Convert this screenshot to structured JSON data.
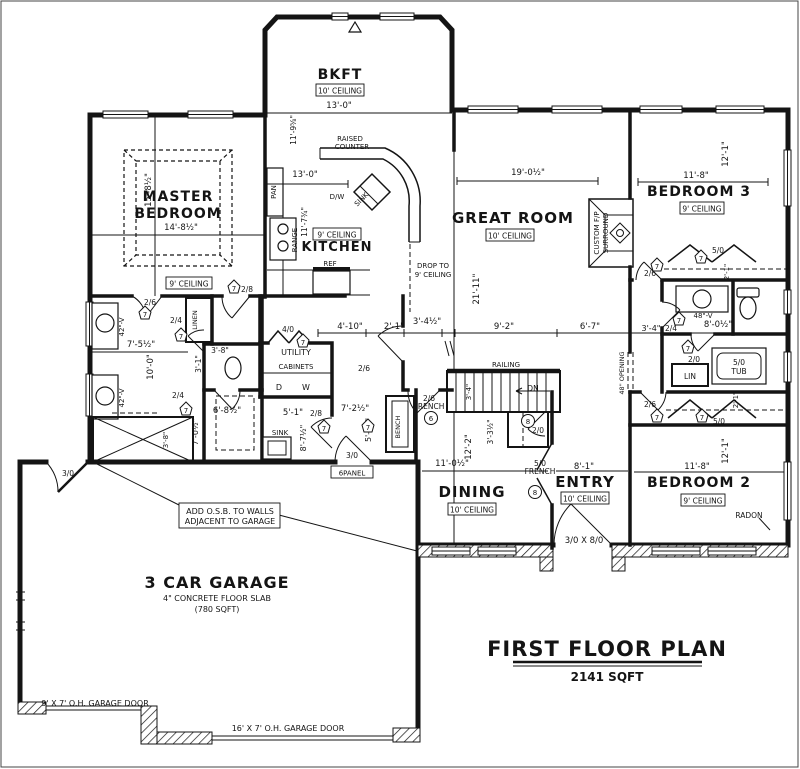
{
  "plan_title": {
    "title": "FIRST FLOOR PLAN",
    "area": "2141 SQFT"
  },
  "rooms": {
    "bkft": {
      "name": "BKFT",
      "ceiling": "10' CEILING"
    },
    "master": {
      "line1": "MASTER",
      "line2": "BEDROOM",
      "ceiling": "9' CEILING",
      "width": "14'-8½\"",
      "height": "15'-8½\""
    },
    "kitchen": {
      "name": "KITCHEN",
      "ceiling": "9' CEILING"
    },
    "great": {
      "name": "GREAT ROOM",
      "ceiling": "10' CEILING",
      "width": "19'-0½\"",
      "height": "21'-11\""
    },
    "bed3": {
      "name": "BEDROOM 3",
      "ceiling": "9' CEILING",
      "width": "11'-8\"",
      "height": "12'-1\""
    },
    "bed2": {
      "name": "BEDROOM 2",
      "ceiling": "9' CEILING",
      "width": "11'-8\"",
      "height": "12'-1\""
    },
    "dining": {
      "name": "DINING",
      "ceiling": "10' CEILING",
      "width": "11'-0½\"",
      "height": "12'-2\""
    },
    "entry": {
      "name": "ENTRY",
      "ceiling": "10' CEILING",
      "width": "8'-1\"",
      "front_door": "3/0 X 8/0"
    },
    "utility": {
      "name": "UTILITY",
      "cabinets": "CABINETS",
      "dryer": "D",
      "washer": "W"
    },
    "garage": {
      "name": "3 CAR GARAGE",
      "slab": "4\" CONCRETE FLOOR SLAB",
      "sqft": "(780 SQFT)",
      "door9": "9' X 7' O.H. GARAGE DOOR",
      "door16": "16' X 7' O.H. GARAGE DOOR",
      "osb1": "ADD O.S.B. TO WALLS",
      "osb2": "ADJACENT TO GARAGE"
    }
  },
  "labels": {
    "raised1": "RAISED",
    "raised2": "COUNTER",
    "dw": "D/W",
    "island_sink": "SINK",
    "pan": "PAN",
    "range": "RANGE",
    "ref": "REF",
    "drop1": "DROP TO",
    "drop2": "9' CEILING",
    "railing": "RAILING",
    "dn": "DN",
    "bench": "BENCH",
    "mud_sink": "SINK",
    "linen": "LINEN",
    "lin": "LIN",
    "tub_size": "5/0",
    "tub": "TUB",
    "vanity42": "42\"-V",
    "vanity48": "48\"-V",
    "opening48": "48\" OPENING",
    "fp1": "CUSTOM F/P",
    "fp2": "SURROUND",
    "radon": "RADON",
    "sixpanel": "6PANEL",
    "french": "FRENCH"
  },
  "doors": {
    "d20": "2/0",
    "d24": "2/4",
    "d26": "2/6",
    "d28": "2/8",
    "d30": "3/0",
    "d40": "4/0",
    "d50": "5/0"
  },
  "markers": {
    "m6": "6",
    "m7": "7",
    "m8": "8"
  },
  "dims": {
    "d13_0": "13'-0\"",
    "d11_9": "11'-9⅝\"",
    "d11_7": "11'-7¾\"",
    "d4_10": "4'-10\"",
    "d2_1": "2'-1\"",
    "d3_4h": "3'-4½\"",
    "d9_2": "9'-2\"",
    "d6_7": "6'-7\"",
    "d3_4": "3'-4\"",
    "d8_0h": "8'-0½\"",
    "d7_5h": "7'-5½\"",
    "d10_0": "10'-0\"",
    "d3_8": "3'-8\"",
    "d3_1": "3'-1\"",
    "d6_8h": "6'-8½\"",
    "d7_0h": "7'-0½\"",
    "d5_1": "5'-1\"",
    "d8_7h": "8'-7½\"",
    "d7_2h": "7'-2½\"",
    "d5_10": "5'-10\"",
    "d3_3h": "3'-3½\"",
    "d11_0h": "11'-0½\"",
    "d12_2": "12'-2\"",
    "d8_1": "8'-1\""
  }
}
